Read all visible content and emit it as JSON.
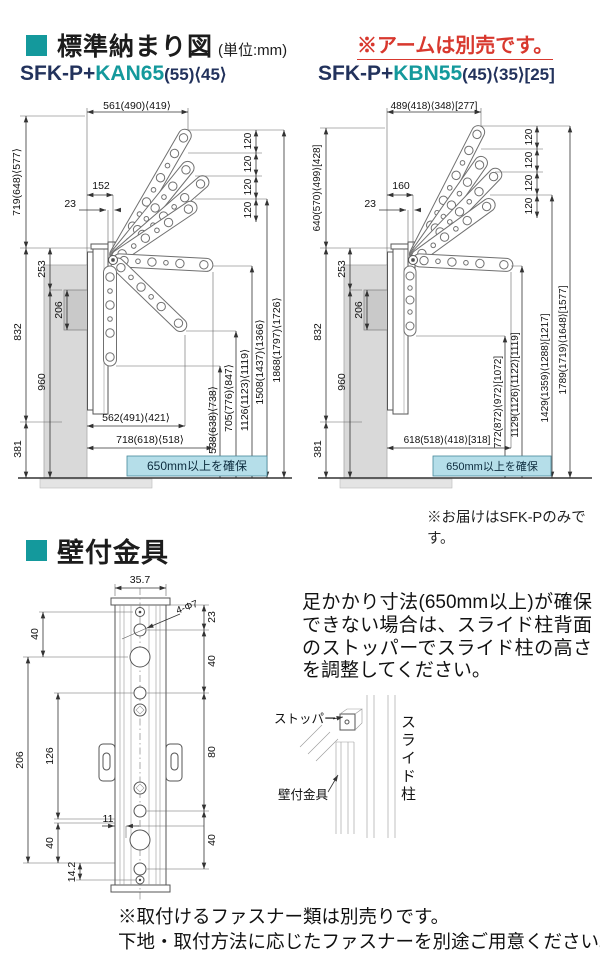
{
  "header": {
    "title": "標準納まり図",
    "unit": "(単位:mm)",
    "arm_note": "※アームは別売です。"
  },
  "diagrams": {
    "left": {
      "title_prefix": "SFK-P+",
      "title_model": "KAN65",
      "title_sizes": "(55)⟨45⟩",
      "dims": {
        "top_width": "561(490)⟨419⟩",
        "height_to_top": "719(648)⟨577⟩",
        "pivot_offset": "152",
        "pivot_gap": "23",
        "bracket_to_pivot": "253",
        "upper_column": "832",
        "bracket_height": "206",
        "lower_column": "960",
        "base": "381",
        "arm_step": "120",
        "reach_inner": "562(491)⟨421⟩",
        "reach_outer": "718(618)⟨518⟩",
        "folded_height": "538(638)⟨738⟩",
        "down_tip_height": "705(776)⟨847⟩",
        "level_tip_height": "1126(1123)⟨1119⟩",
        "raised_low_height": "1508(1437)⟨1366⟩",
        "raised_top_height": "1868(1797)⟨1726⟩",
        "clearance": "650mm以上を確保"
      }
    },
    "right": {
      "title_prefix": "SFK-P+",
      "title_model": "KBN55",
      "title_sizes": "(45)⟨35⟩[25]",
      "dims": {
        "top_width": "489(418)⟨348⟩[277]",
        "height_to_top": "640(570)⟨499⟩[428]",
        "pivot_offset": "160",
        "pivot_gap": "23",
        "bracket_to_pivot": "253",
        "upper_column": "832",
        "bracket_height": "206",
        "lower_column": "960",
        "base": "381",
        "arm_step": "120",
        "reach_outer": "618(518)⟨418⟩[318]",
        "folded_height": "772(872)⟨972⟩[1072]",
        "level_tip_height": "1129(1126)⟨1122⟩[1119]",
        "raised_low_height": "1429(1359)⟨1288⟩[1217]",
        "raised_top_height": "1789(1719)⟨1648⟩[1577]",
        "clearance": "650mm以上を確保"
      }
    },
    "delivery_note": "※お届けはSFK-Pのみです。"
  },
  "bracket_section": {
    "title": "壁付金具",
    "dims": {
      "width": "35.7",
      "hole_spec": "4-Φ7",
      "top_to_hole": "23",
      "pitch_upper": "40",
      "pitch_middle": "80",
      "pitch_lower": "40",
      "left_top": "40",
      "overall": "206",
      "inner": "126",
      "left_bottom": "40",
      "bottom_edge": "14.2",
      "side_offset": "11"
    },
    "note": "足かかり寸法(650mm以上)が確保できない場合は、スライド柱背面のストッパーでスライド柱の高さを調整してください。",
    "inset_labels": {
      "stopper": "ストッパー",
      "slide_pole": "スライド柱",
      "wall_bracket": "壁付金具"
    },
    "footnote1": "※取付けるファスナー類は別売りです。",
    "footnote2": "下地・取付方法に応じたファスナーを別途ご用意ください。"
  },
  "colors": {
    "teal": "#14999c",
    "red": "#d8382e",
    "navy": "#22325c",
    "highlight_bg": "#b5dee9",
    "line": "#333333"
  }
}
